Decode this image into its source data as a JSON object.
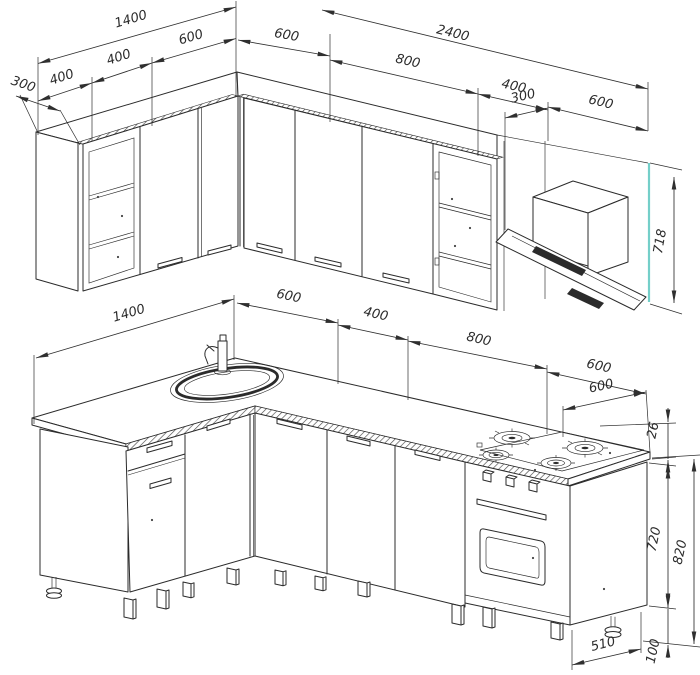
{
  "drawing": {
    "type": "kitchen-furniture-technical-drawing",
    "views": [
      "upper-wall-cabinets",
      "base-cabinets"
    ]
  },
  "dimensions": {
    "upper": {
      "left_total": "1400",
      "left_segment_600": "600",
      "left_segment_400_mid": "400",
      "left_segment_400_end": "400",
      "left_depth_300": "300",
      "corner_600": "600",
      "right_total": "2400",
      "right_segment_800": "800",
      "right_segment_400": "400",
      "hood_offset_300": "300",
      "hood_width_600": "600",
      "height_718": "718"
    },
    "lower": {
      "left_total": "1400",
      "corner_600": "600",
      "segment_400": "400",
      "segment_800": "800",
      "hob_width_600": "600",
      "hob_depth_600": "600",
      "countertop_thickness_26": "26",
      "carcass_height_720": "720",
      "total_height_820": "820",
      "leg_height_100": "100",
      "oven_depth_510": "510"
    }
  },
  "colors": {
    "line": "#2b2b2b",
    "accent_teal": "#74cfc9",
    "background": "#ffffff"
  }
}
